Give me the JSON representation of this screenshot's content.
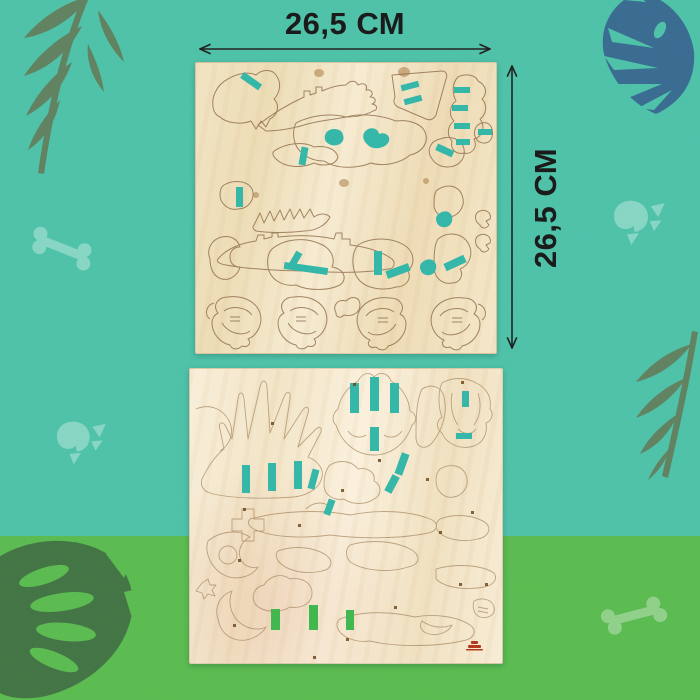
{
  "annotations": {
    "width_label": "26,5 СМ",
    "height_label": "26,5 СМ"
  },
  "boards": {
    "count": 2,
    "top_board": "laser-cut plywood sheet with dinosaur skeleton puzzle pieces and teal painted slots",
    "bottom_board": "laser-cut plywood sheet with dinosaur puzzle pieces, tiny part-number stamps, teal and green painted slots, red maker stamp"
  },
  "decor_icons": [
    "palm-frond-icon",
    "monstera-leaf-icon",
    "skull-icon",
    "bone-icon"
  ],
  "colors": {
    "background_top": "#4ac0a6",
    "background_bottom": "#57b94c",
    "wood_light": "#f2e3c2",
    "wood_lighter": "#f8eed9",
    "cut_line": "#8a6742",
    "accent_teal": "#2fb5a6",
    "accent_green": "#3cb54a",
    "leaf_olive": "#5d7f5d",
    "leaf_blue": "#35688e",
    "leaf_dark_green": "#3e7140",
    "dimension_text": "#141414",
    "logo_red": "#b23418"
  }
}
